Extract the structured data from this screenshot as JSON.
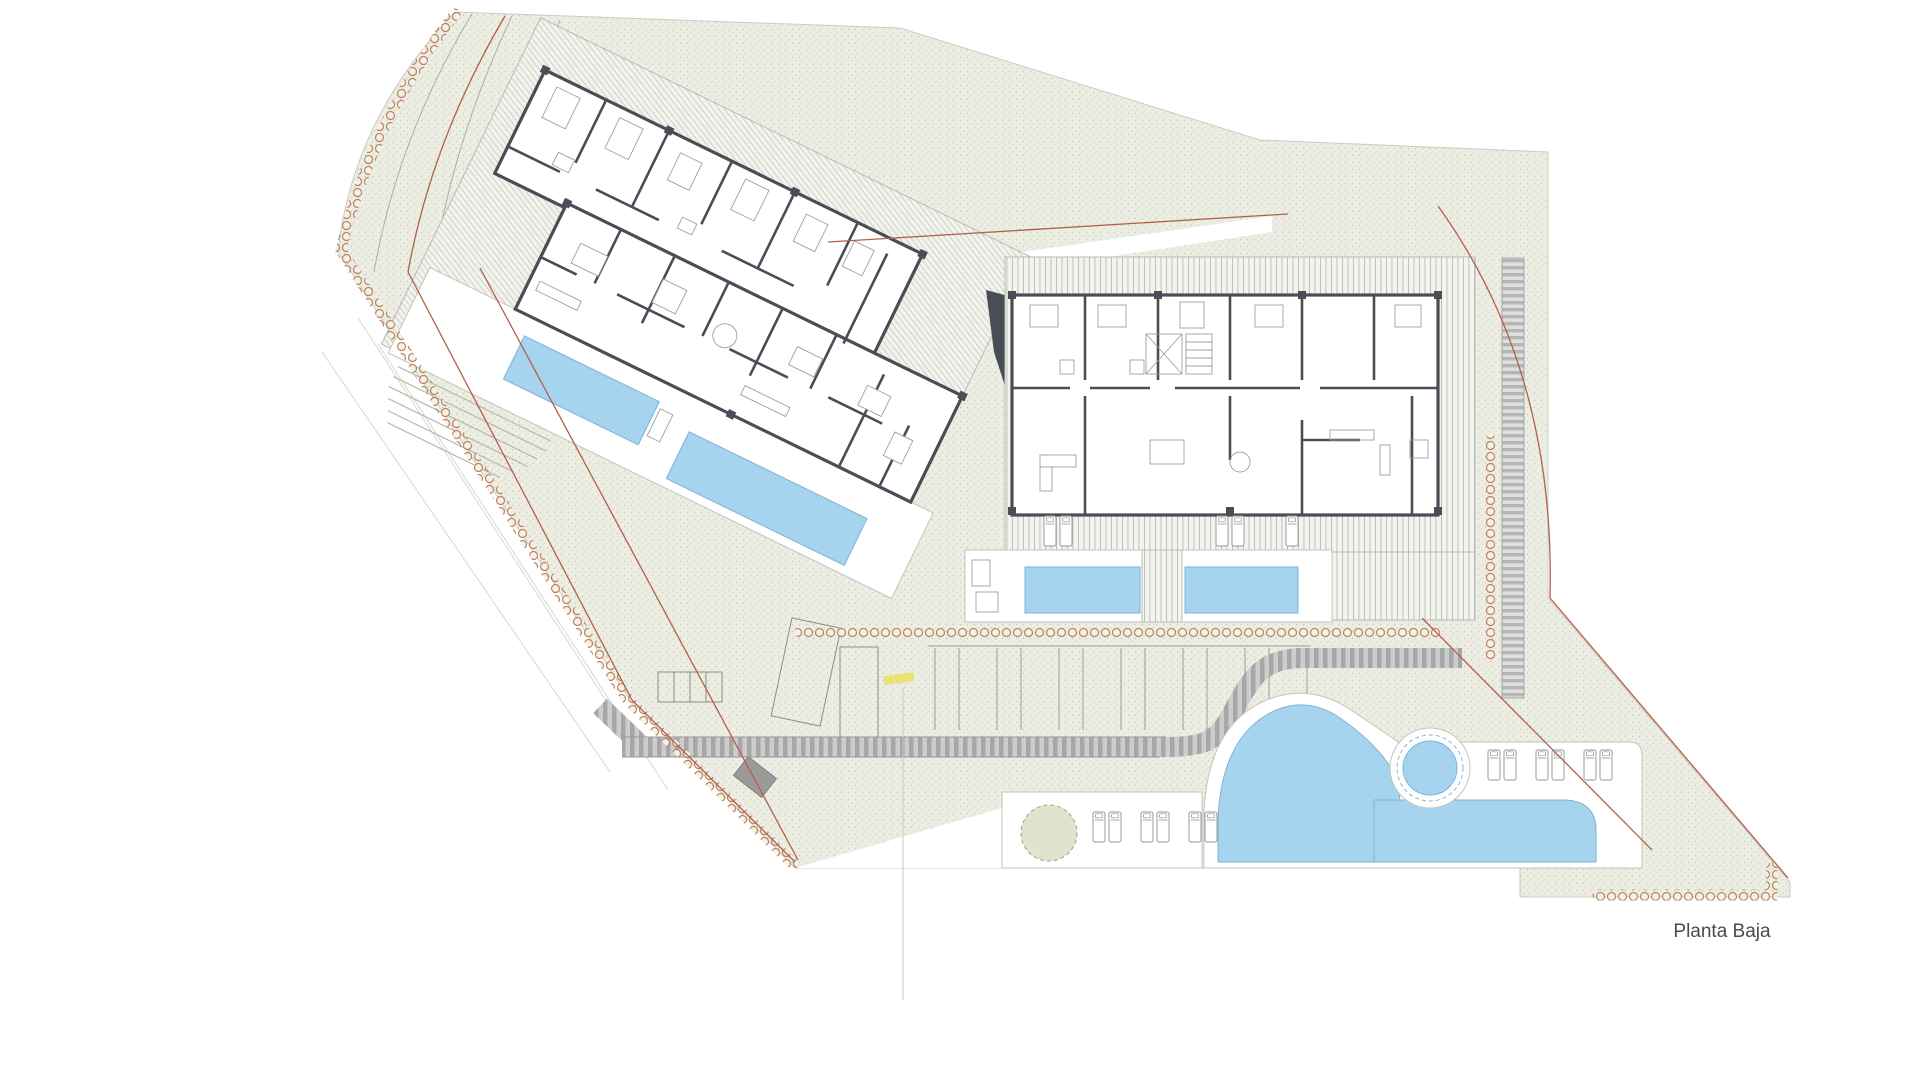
{
  "sheet": {
    "title": "Planta Baja"
  },
  "colors": {
    "pool": "#a6d4ee",
    "pool_stroke": "#7fb3d5",
    "site": "#ecede3",
    "wall": "#494e56",
    "stone": "#b9855f",
    "red": "#b2604a",
    "road_a": "#a7a7a7",
    "road_b": "#cdcdcd",
    "tan_fill": "#e2e3cc",
    "yellow": "#e9e06c",
    "faint": "#c9ccc0",
    "text": "#4a4a4a"
  },
  "features": {
    "west_building": "rotated apartment block with two terrace pools",
    "east_building": "apartment block with two terrace pools",
    "lagoon_pool": "free-form pool with round spa",
    "parking": "parking stalls along access road"
  }
}
